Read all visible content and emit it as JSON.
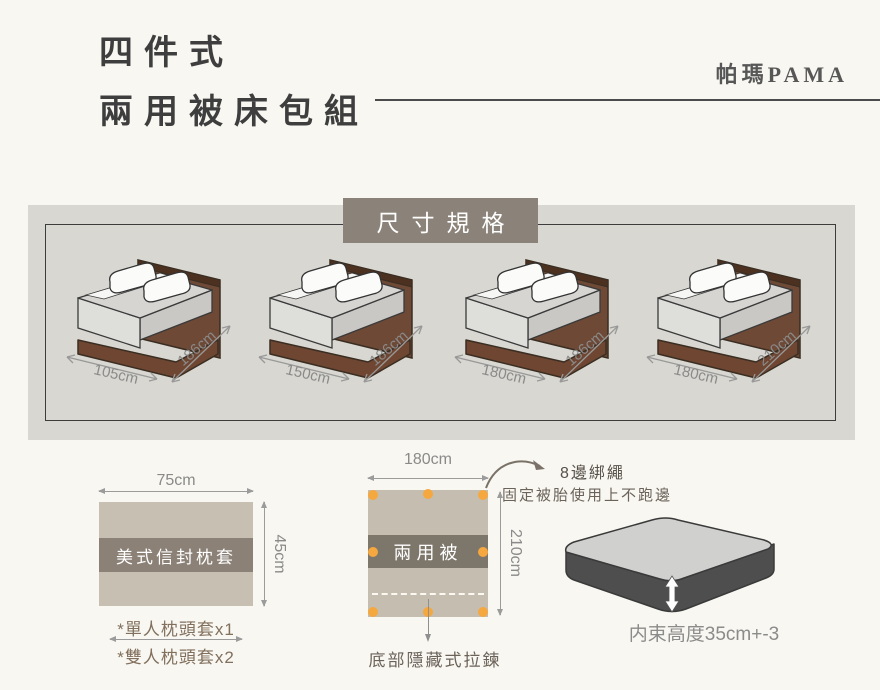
{
  "header": {
    "title_line1": "四件式",
    "title_line2": "兩用被床包組",
    "brand": "帕瑪PAMA"
  },
  "spec_panel": {
    "badge": "尺寸規格",
    "beds": [
      {
        "width": "105cm",
        "length": "186cm"
      },
      {
        "width": "150cm",
        "length": "186cm"
      },
      {
        "width": "180cm",
        "length": "186cm"
      },
      {
        "width": "180cm",
        "length": "210cm"
      }
    ]
  },
  "pillow": {
    "top_dim": "75cm",
    "side_dim": "45cm",
    "label": "美式信封枕套",
    "note1": "*單人枕頭套x1",
    "note2": "*雙人枕頭套x2"
  },
  "quilt": {
    "top_dim": "180cm",
    "side_dim": "210cm",
    "label": "兩用被",
    "tie_note_title": "8邊綁繩",
    "tie_note_sub": "固定被胎使用上不跑邊",
    "zipper_note": "底部隱藏式拉鍊"
  },
  "mattress": {
    "height_note": "内束高度35cm+-3"
  },
  "colors": {
    "page_bg": "#f8f7f1",
    "panel_bg": "#d8d7d1",
    "badge_bg": "#8b8379",
    "pillow_body": "#c8bfb3",
    "pillow_band": "#8b8177",
    "quilt_body": "#c5bdb0",
    "quilt_band": "#7d766b",
    "tie_dot_orange": "#f5a83f",
    "bed_frame_brown": "#6e4936",
    "mattress_side_gray": "#4e4e4e",
    "dim_text_gray": "#8a8a8a"
  }
}
